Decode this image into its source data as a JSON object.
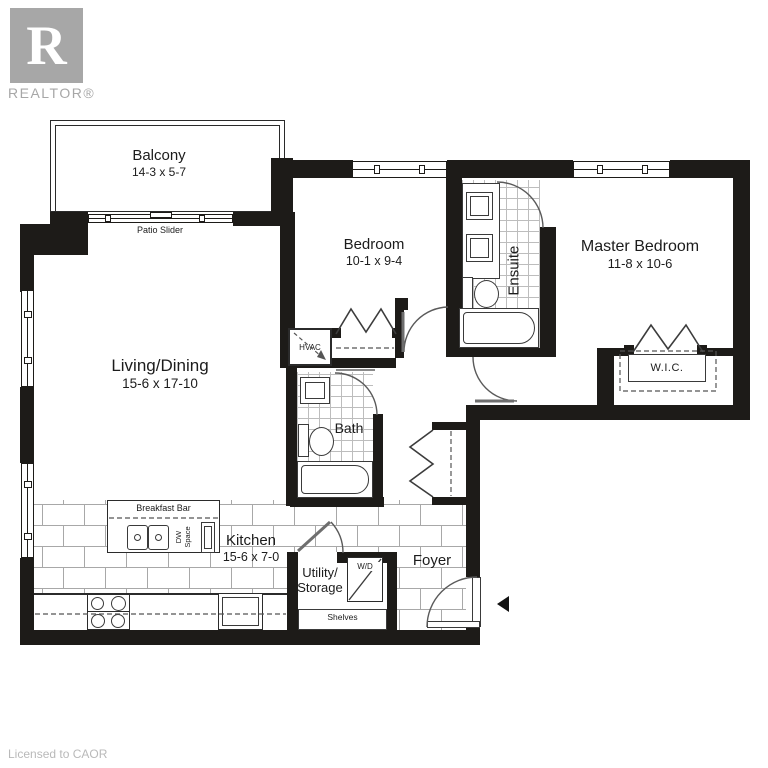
{
  "branding": {
    "logo_letter": "R",
    "logo_name": "REALTOR®",
    "license": "Licensed to CAOR"
  },
  "rooms": {
    "balcony": {
      "name": "Balcony",
      "dims": "14-3 x 5-7"
    },
    "bedroom": {
      "name": "Bedroom",
      "dims": "10-1 x 9-4"
    },
    "master_bedroom": {
      "name": "Master Bedroom",
      "dims": "11-8 x 10-6"
    },
    "ensuite": {
      "name": "Ensuite"
    },
    "living_dining": {
      "name": "Living/Dining",
      "dims": "15-6 x 17-10"
    },
    "bath": {
      "name": "Bath"
    },
    "wic": {
      "name": "W.I.C."
    },
    "kitchen": {
      "name": "Kitchen",
      "dims": "15-6 x 7-0"
    },
    "utility": {
      "line1": "Utility/",
      "line2": "Storage"
    },
    "foyer": {
      "name": "Foyer"
    }
  },
  "labels": {
    "patio_slider": "Patio Slider",
    "breakfast_bar": "Breakfast Bar",
    "dw_line1": "DW",
    "dw_line2": "Space",
    "hvac": "HVAC",
    "wd": "W/D",
    "shelves": "Shelves"
  },
  "colors": {
    "wall": "#1d1b18",
    "logo_gray": "#a7a7a7",
    "tile_line": "#a8a8a8",
    "entry_arrow": "#111111"
  }
}
